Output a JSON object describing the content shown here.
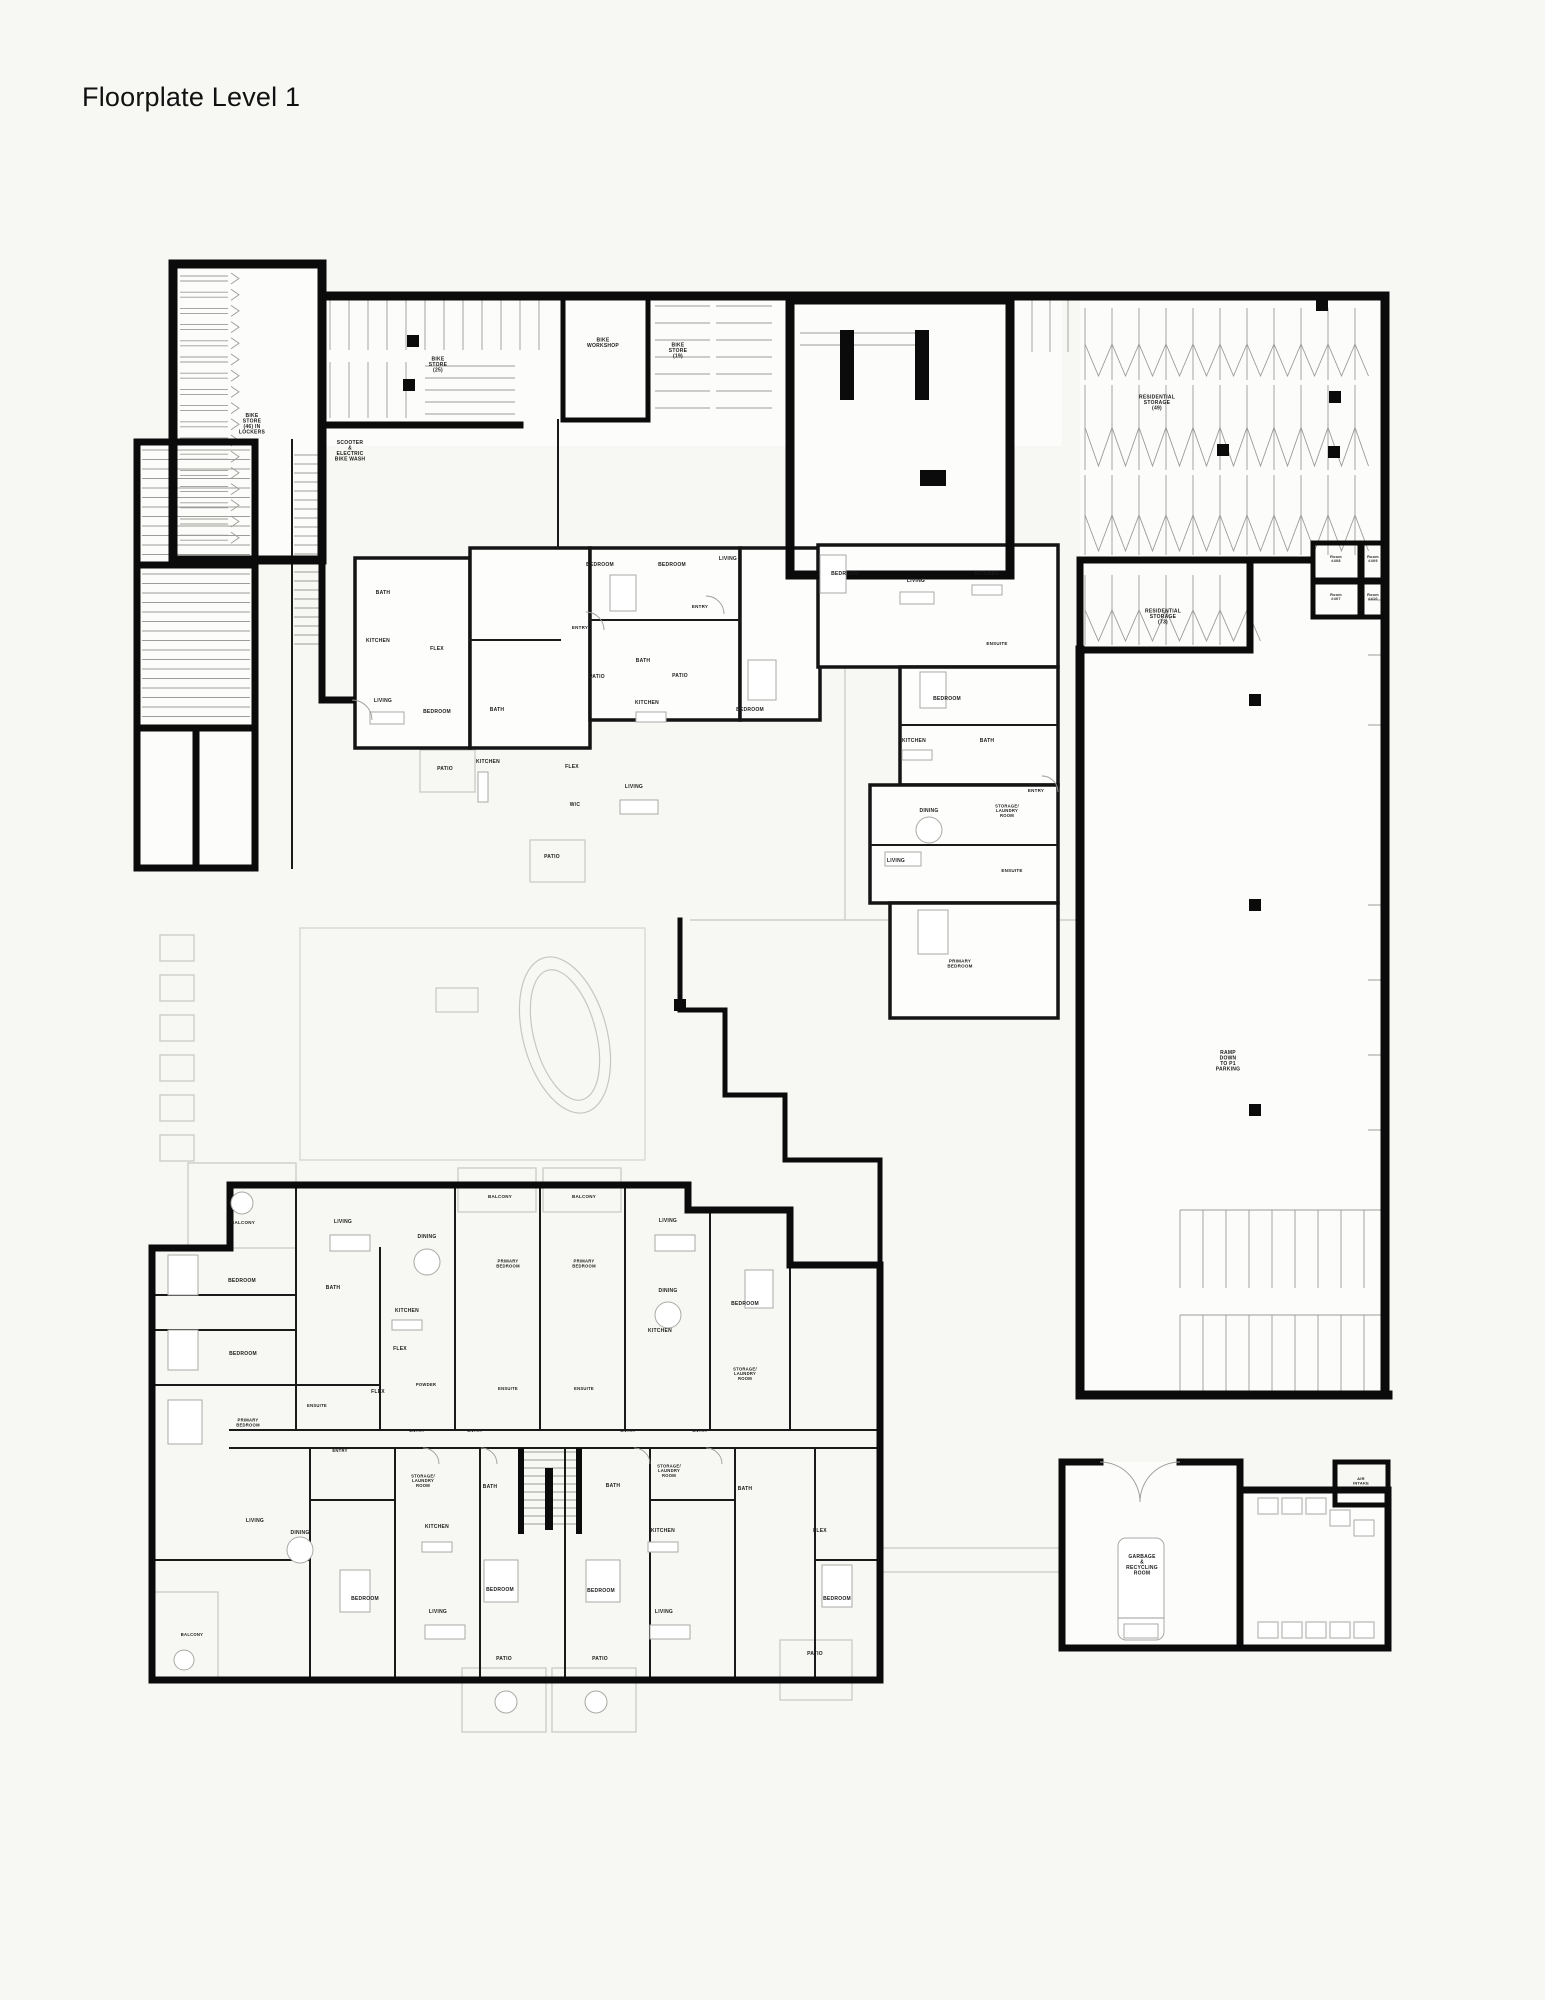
{
  "page": {
    "title": "Floorplate Level 1"
  },
  "colors": {
    "background": "#f7f7f4",
    "wall": "#0b0b0b",
    "detail_gray": "#9b9b98",
    "landscape_gray": "#c6c6c3",
    "text": "#1b1b1b"
  },
  "plan": {
    "labels": [
      {
        "t": "BIKE\nSTORE\n(46) IN\nLOCKERS",
        "x": 252,
        "y": 425,
        "n": "bike-store-lockers-label"
      },
      {
        "t": "SCOOTER\n&\nELECTRIC\nBIKE WASH",
        "x": 350,
        "y": 452,
        "n": "scooter-ebike-wash-label"
      },
      {
        "t": "BIKE\nSTORE\n(25)",
        "x": 438,
        "y": 366,
        "n": "bike-store-25-label"
      },
      {
        "t": "BIKE\nWORKSHOP",
        "x": 603,
        "y": 344,
        "n": "bike-workshop-label"
      },
      {
        "t": "BIKE\nSTORE\n(19)",
        "x": 678,
        "y": 352,
        "n": "bike-store-19-label"
      },
      {
        "t": "RESIDENTIAL\nSTORAGE\n(49)",
        "x": 1157,
        "y": 404,
        "n": "residential-storage-49-label"
      },
      {
        "t": "RESIDENTIAL\nSTORAGE\n(73)",
        "x": 1163,
        "y": 618,
        "n": "residential-storage-73-label"
      },
      {
        "t": "RAMP\nDOWN\nTO P1\nPARKING",
        "x": 1228,
        "y": 1062,
        "n": "ramp-down-p1-label"
      },
      {
        "t": "GARBAGE\n&\nRECYCLING\nROOM",
        "x": 1142,
        "y": 1566,
        "n": "garbage-recycling-label"
      },
      {
        "t": "AIR\nINTAKE",
        "x": 1361,
        "y": 1482,
        "s": 4,
        "n": "air-intake-label"
      },
      {
        "t": "Room\n#408",
        "x": 1336,
        "y": 560,
        "s": 3.8,
        "n": "room-408-label"
      },
      {
        "t": "Room\n#409",
        "x": 1373,
        "y": 560,
        "s": 3.8,
        "n": "room-409-label"
      },
      {
        "t": "Room\n#407",
        "x": 1336,
        "y": 598,
        "s": 3.8,
        "n": "room-407-label"
      },
      {
        "t": "Room\n#410",
        "x": 1373,
        "y": 598,
        "s": 3.8,
        "n": "room-410-label"
      },
      {
        "t": "BATH",
        "x": 383,
        "y": 594
      },
      {
        "t": "FLEX",
        "x": 437,
        "y": 650
      },
      {
        "t": "KITCHEN",
        "x": 378,
        "y": 642
      },
      {
        "t": "LIVING",
        "x": 383,
        "y": 702
      },
      {
        "t": "BEDROOM",
        "x": 437,
        "y": 713
      },
      {
        "t": "PATIO",
        "x": 445,
        "y": 770
      },
      {
        "t": "ENTRY",
        "x": 580,
        "y": 629,
        "s": 4.5
      },
      {
        "t": "ENTRY",
        "x": 700,
        "y": 608,
        "s": 4.5
      },
      {
        "t": "BATH",
        "x": 643,
        "y": 662
      },
      {
        "t": "KITCHEN",
        "x": 647,
        "y": 704
      },
      {
        "t": "BEDROOM",
        "x": 750,
        "y": 711
      },
      {
        "t": "BATH",
        "x": 497,
        "y": 711
      },
      {
        "t": "KITCHEN",
        "x": 488,
        "y": 763
      },
      {
        "t": "FLEX",
        "x": 572,
        "y": 768
      },
      {
        "t": "LIVING",
        "x": 634,
        "y": 788
      },
      {
        "t": "W/C",
        "x": 575,
        "y": 806
      },
      {
        "t": "BEDROOM",
        "x": 600,
        "y": 566
      },
      {
        "t": "BEDROOM",
        "x": 672,
        "y": 566
      },
      {
        "t": "LIVING",
        "x": 728,
        "y": 560
      },
      {
        "t": "PATIO",
        "x": 597,
        "y": 678
      },
      {
        "t": "PATIO",
        "x": 680,
        "y": 677
      },
      {
        "t": "PATIO",
        "x": 552,
        "y": 858
      },
      {
        "t": "BEDROOM",
        "x": 845,
        "y": 575
      },
      {
        "t": "LIVING",
        "x": 916,
        "y": 582
      },
      {
        "t": "KITCHEN",
        "x": 987,
        "y": 575
      },
      {
        "t": "ENSUITE",
        "x": 997,
        "y": 645,
        "s": 4.5
      },
      {
        "t": "BEDROOM",
        "x": 947,
        "y": 700
      },
      {
        "t": "KITCHEN",
        "x": 914,
        "y": 742
      },
      {
        "t": "BATH",
        "x": 987,
        "y": 742
      },
      {
        "t": "DINING",
        "x": 929,
        "y": 812
      },
      {
        "t": "STORAGE/\nLAUNDRY\nROOM",
        "x": 1007,
        "y": 812,
        "s": 4.2
      },
      {
        "t": "LIVING",
        "x": 896,
        "y": 862
      },
      {
        "t": "ENSUITE",
        "x": 1012,
        "y": 872,
        "s": 4.5
      },
      {
        "t": "ENTRY",
        "x": 1036,
        "y": 792,
        "s": 4.5
      },
      {
        "t": "PRIMARY\nBEDROOM",
        "x": 960,
        "y": 965,
        "s": 4.5
      },
      {
        "t": "BALCONY",
        "x": 243,
        "y": 1224,
        "s": 4.5
      },
      {
        "t": "LIVING",
        "x": 343,
        "y": 1223
      },
      {
        "t": "DINING",
        "x": 427,
        "y": 1238
      },
      {
        "t": "BALCONY",
        "x": 500,
        "y": 1198,
        "s": 4.5
      },
      {
        "t": "BALCONY",
        "x": 584,
        "y": 1198,
        "s": 4.5
      },
      {
        "t": "LIVING",
        "x": 668,
        "y": 1222
      },
      {
        "t": "PRIMARY\nBEDROOM",
        "x": 508,
        "y": 1265,
        "s": 4.2
      },
      {
        "t": "PRIMARY\nBEDROOM",
        "x": 584,
        "y": 1265,
        "s": 4.2
      },
      {
        "t": "BEDROOM",
        "x": 242,
        "y": 1282
      },
      {
        "t": "BATH",
        "x": 333,
        "y": 1289
      },
      {
        "t": "KITCHEN",
        "x": 407,
        "y": 1312
      },
      {
        "t": "DINING",
        "x": 668,
        "y": 1292
      },
      {
        "t": "BEDROOM",
        "x": 745,
        "y": 1305
      },
      {
        "t": "BEDROOM",
        "x": 243,
        "y": 1355
      },
      {
        "t": "FLEX",
        "x": 400,
        "y": 1350
      },
      {
        "t": "KITCHEN",
        "x": 660,
        "y": 1332
      },
      {
        "t": "POWDER",
        "x": 426,
        "y": 1386,
        "s": 4.2
      },
      {
        "t": "FLEX",
        "x": 378,
        "y": 1393
      },
      {
        "t": "ENSUITE",
        "x": 317,
        "y": 1407,
        "s": 4.2
      },
      {
        "t": "ENSUITE",
        "x": 508,
        "y": 1390,
        "s": 4.2
      },
      {
        "t": "ENSUITE",
        "x": 584,
        "y": 1390,
        "s": 4.2
      },
      {
        "t": "PRIMARY\nBEDROOM",
        "x": 248,
        "y": 1424,
        "s": 4.2
      },
      {
        "t": "STORAGE/\nLAUNDRY\nROOM",
        "x": 745,
        "y": 1375,
        "s": 4.2
      },
      {
        "t": "ENTRY",
        "x": 417,
        "y": 1432,
        "s": 4.2
      },
      {
        "t": "ENTRY",
        "x": 475,
        "y": 1432,
        "s": 4.2
      },
      {
        "t": "ENTRY",
        "x": 628,
        "y": 1432,
        "s": 4.2
      },
      {
        "t": "ENTRY",
        "x": 700,
        "y": 1432,
        "s": 4.2
      },
      {
        "t": "ENTRY",
        "x": 340,
        "y": 1452,
        "s": 4.2
      },
      {
        "t": "STORAGE/\nLAUNDRY\nROOM",
        "x": 423,
        "y": 1482,
        "s": 4.2
      },
      {
        "t": "STORAGE/\nLAUNDRY\nROOM",
        "x": 669,
        "y": 1472,
        "s": 4.2
      },
      {
        "t": "BATH",
        "x": 490,
        "y": 1488
      },
      {
        "t": "BATH",
        "x": 613,
        "y": 1487
      },
      {
        "t": "BATH",
        "x": 745,
        "y": 1490
      },
      {
        "t": "LIVING",
        "x": 255,
        "y": 1522
      },
      {
        "t": "DINING",
        "x": 300,
        "y": 1534
      },
      {
        "t": "KITCHEN",
        "x": 437,
        "y": 1528
      },
      {
        "t": "KITCHEN",
        "x": 663,
        "y": 1532
      },
      {
        "t": "FLEX",
        "x": 820,
        "y": 1532
      },
      {
        "t": "BEDROOM",
        "x": 500,
        "y": 1591
      },
      {
        "t": "BEDROOM",
        "x": 601,
        "y": 1592
      },
      {
        "t": "BEDROOM",
        "x": 365,
        "y": 1600
      },
      {
        "t": "BEDROOM",
        "x": 837,
        "y": 1600
      },
      {
        "t": "LIVING",
        "x": 438,
        "y": 1613
      },
      {
        "t": "LIVING",
        "x": 664,
        "y": 1613
      },
      {
        "t": "PATIO",
        "x": 504,
        "y": 1660
      },
      {
        "t": "PATIO",
        "x": 600,
        "y": 1660
      },
      {
        "t": "PATIO",
        "x": 815,
        "y": 1655
      },
      {
        "t": "BALCONY",
        "x": 192,
        "y": 1636,
        "s": 4.2
      }
    ]
  }
}
